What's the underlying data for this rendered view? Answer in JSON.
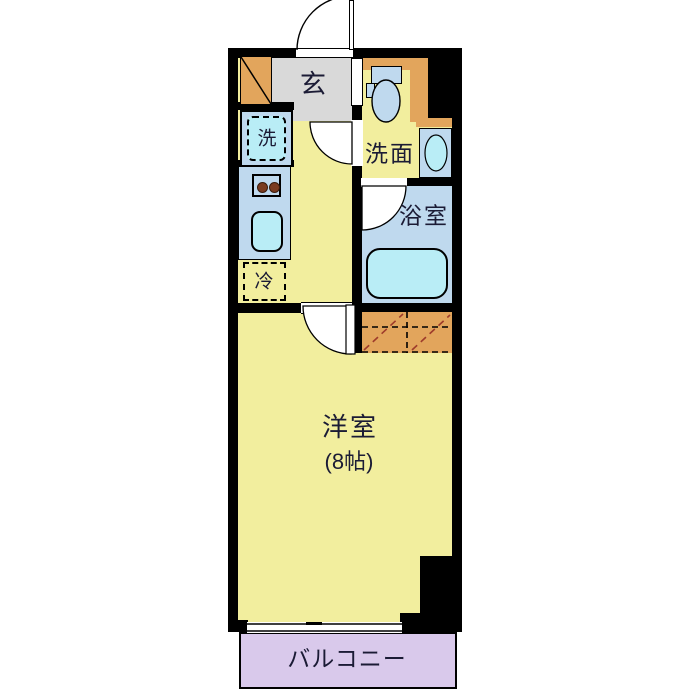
{
  "floor_plan": {
    "rooms": {
      "entrance_label": "玄",
      "washroom_label": "洗面",
      "bathroom_label": "浴室",
      "main_room_label": "洋室",
      "main_room_size_label": "(8帖)",
      "balcony_label": "バルコニー"
    },
    "appliances": {
      "washing_machine_label": "洗",
      "refrigerator_label": "冷"
    },
    "colors": {
      "room_yellow": "#F2EE9E",
      "genkan_gray": "#D9D9D9",
      "storage_orange": "#E2A55C",
      "fixture_blue": "#BFD9EE",
      "water_cyan": "#B9EDF6",
      "balcony_lavender": "#D9C9EB",
      "wall_black": "#000000",
      "label_text": "#1B1B35",
      "closet_diagonal": "#9E3B2B",
      "burner_brown": "#7A3B20"
    }
  }
}
